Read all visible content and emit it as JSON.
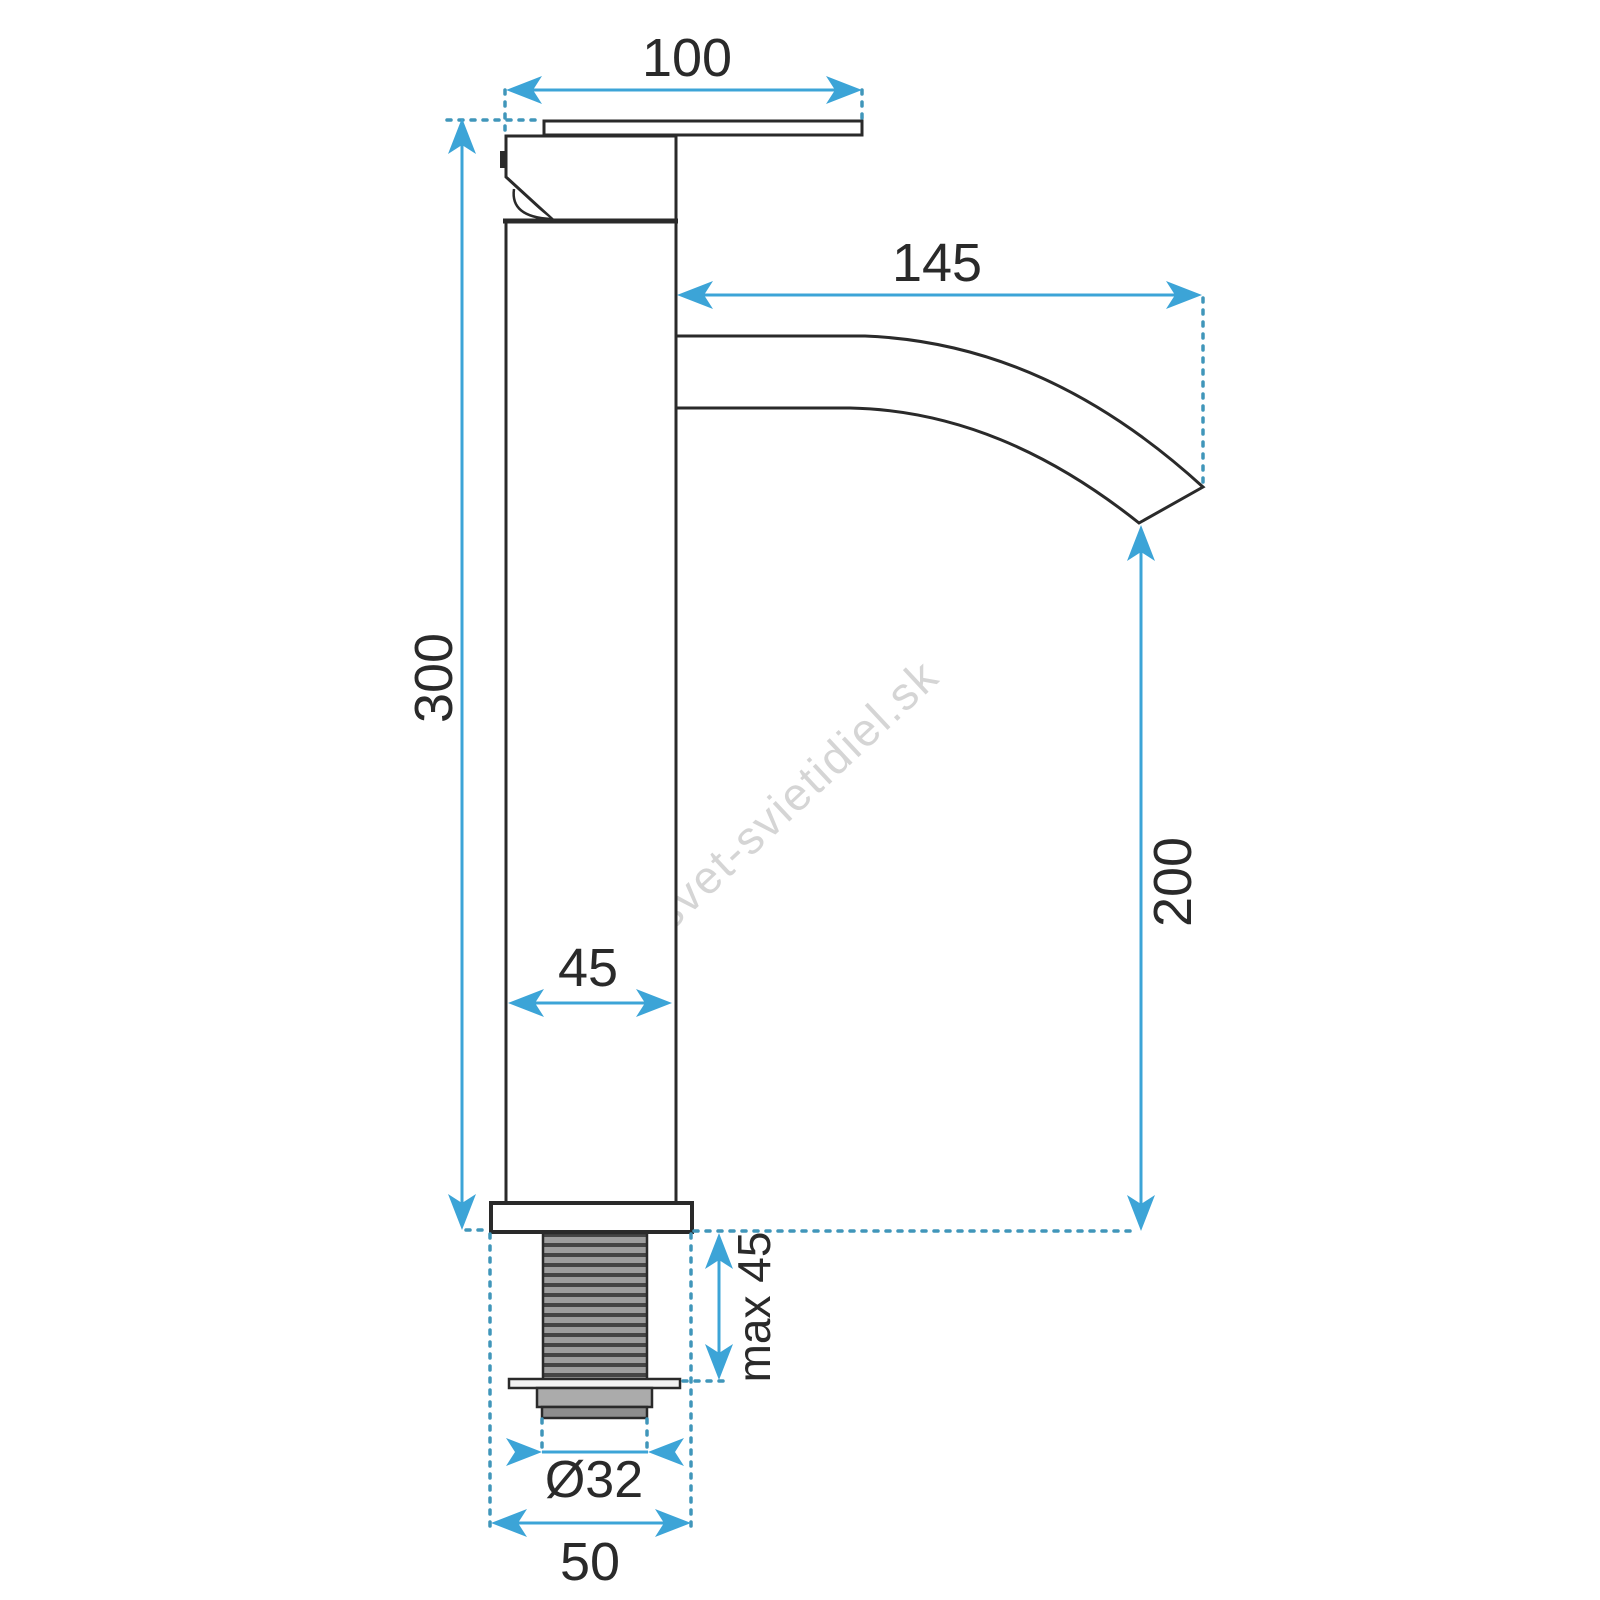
{
  "diagram": {
    "title": "faucet-dimension-drawing",
    "watermark": "svet-svietidiel.sk",
    "labels": {
      "handle_width": "100",
      "spout_reach": "145",
      "total_height": "300",
      "spout_height": "200",
      "body_diameter": "45",
      "max_mount_thickness": "max 45",
      "thread_diameter": "Ø32",
      "base_diameter": "50"
    },
    "colors": {
      "dimension": "#3ca4d7",
      "guide": "#4096ba",
      "line": "#2a2a2a",
      "watermark": "#d5d5d5",
      "thread-light": "#9e9e9e",
      "thread-dark": "#454545",
      "nut": "#ababab",
      "nut-dark": "#8d8d8d",
      "washer": "#f2f2f2",
      "background": "#ffffff"
    }
  }
}
